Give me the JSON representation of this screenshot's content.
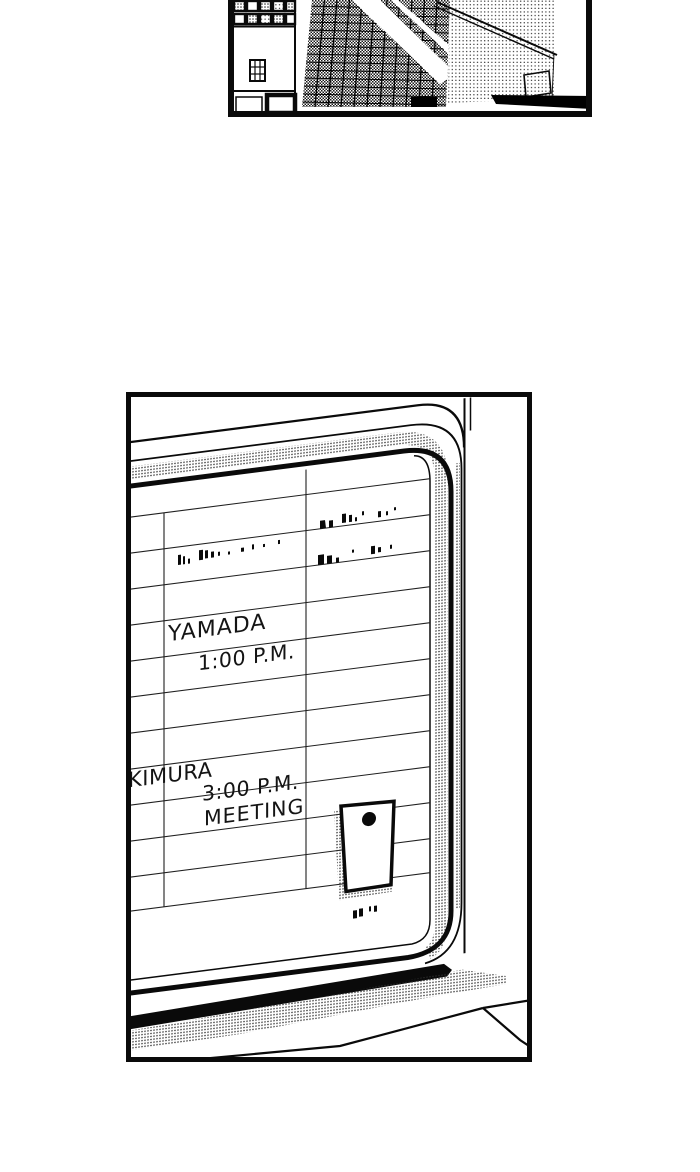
{
  "colors": {
    "ink": "#0a0a0a",
    "paper": "#ffffff"
  },
  "whiteboard": {
    "entries": [
      {
        "name": "YAMADA",
        "time": "1:00 P.M.",
        "note": ""
      },
      {
        "name": "KIMURA",
        "time": "3:00 P.M.",
        "note": "MEETING"
      }
    ]
  }
}
